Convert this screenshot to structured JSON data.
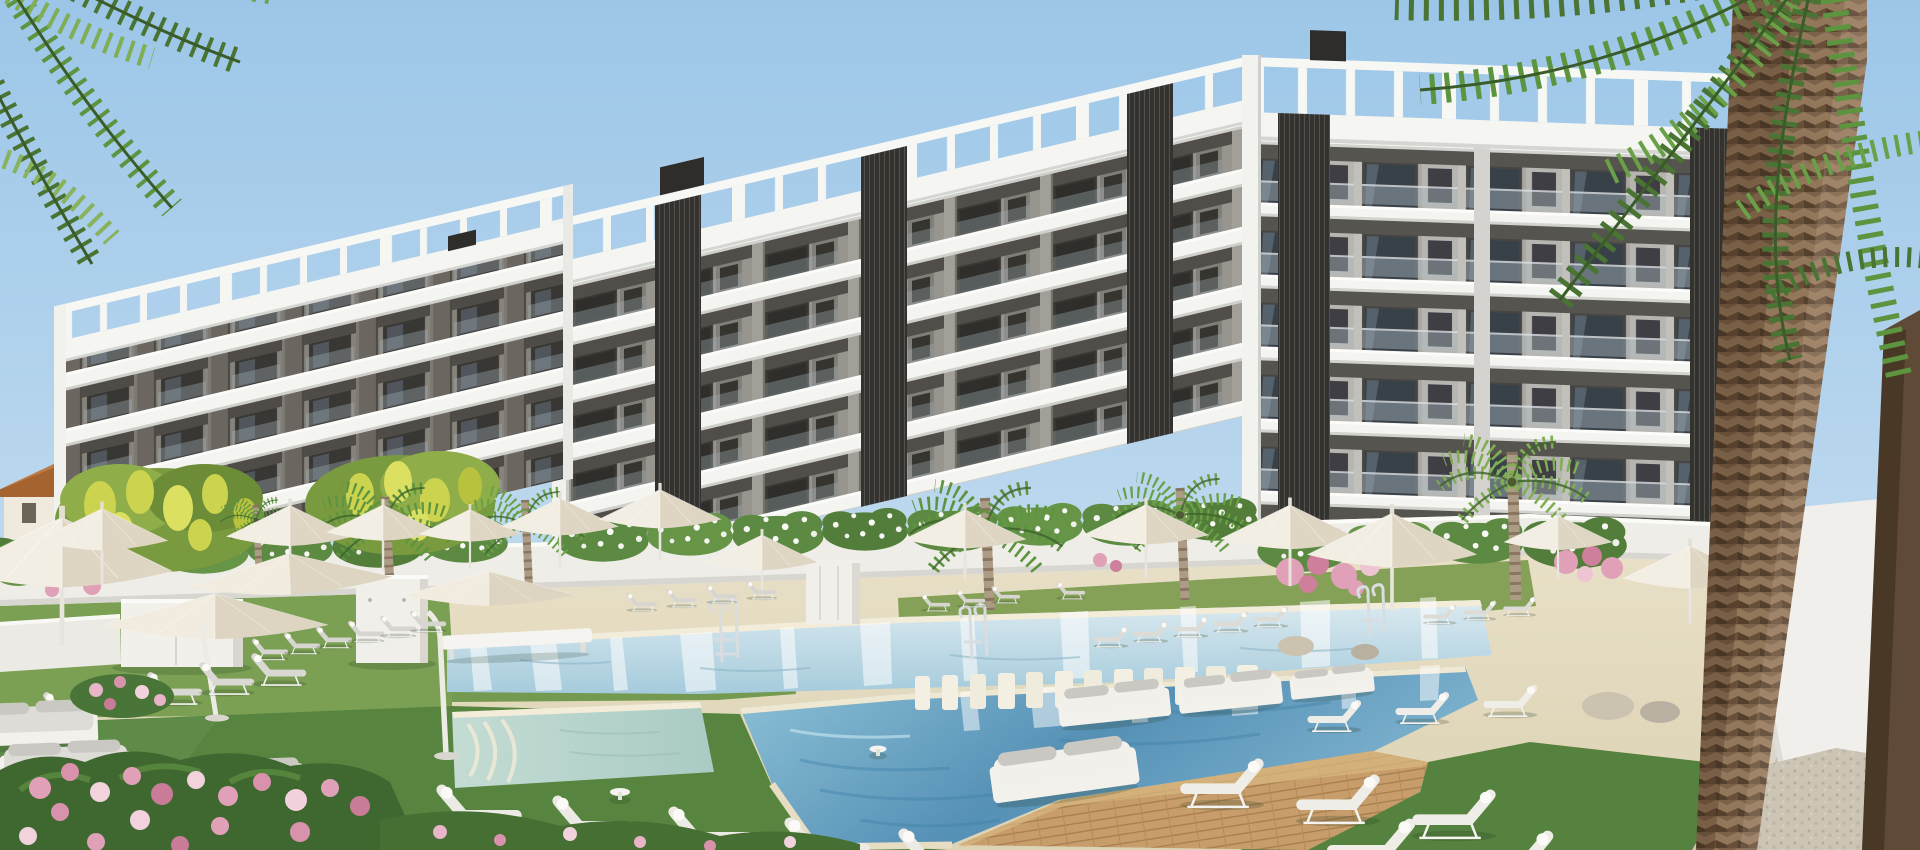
{
  "palette": {
    "sky_top": "#9cc6e8",
    "sky_bottom": "#cfe3f2",
    "slab_white": "#f4f4f1",
    "building_wall_a": "#98948e",
    "building_wall_b": "#aaa8a3",
    "building_wall_l": "#86827c",
    "recess_dark": "#3a3733",
    "louver_dark": "#34322f",
    "pergola_white": "#f7f7f4",
    "lawn_far": "#90a863",
    "lawn_mid": "#6f9450",
    "lawn_near": "#4f7e3b",
    "deck_top": "#e9e1c8",
    "deck_bottom": "#dcd2b4",
    "wood_deck": "#c79e6b",
    "far_water_light": "#dceaf0",
    "far_water": "#a5cbdc",
    "near_water_light": "#8fc3d8",
    "near_water_deep": "#5590b5",
    "spa_water": "#c4dcd3",
    "umbrella_light": "#f3eee3",
    "umbrella_dark": "#ded6c3",
    "lounger_frame": "#f9f8f5",
    "pad_gray": "#d6d5d0",
    "pad_white": "#eceae4",
    "palm_green_dark": "#4a7433",
    "palm_green": "#5d9440",
    "palm_green_light": "#7fae55",
    "trunk_brown": "#7b6148",
    "trunk_ring": "#8a7660",
    "flower_pink": "#e0a0b8",
    "flower_purple": "#ab8ecb",
    "blossom_yellow": "#ccd44f",
    "roof_terracotta": "#bd7a45",
    "wall_white": "#eeede8",
    "gravel": "#ccc5b6"
  },
  "scene": {
    "description": "3D architectural rendering of a modern white apartment complex with rooftop pergolas, dark louvered accents, landscaped gardens, palm trees and a large outdoor pool area with cream parasols and white sun loungers",
    "time_of_day": "sunny clear daytime",
    "buildings": [
      {
        "name": "left-apartment-block",
        "visible_floors": 4,
        "style": "white slabs, dark balcony recesses, rooftop pergola"
      },
      {
        "name": "right-apartment-block-west-wing",
        "visible_floors": 5,
        "style": "white slabs, dark louver columns, rooftop pergola"
      },
      {
        "name": "right-apartment-block-south-wing",
        "visible_floors": 6,
        "style": "glass balustrades, gray panels, rooftop pergola"
      },
      {
        "name": "background-villas",
        "style": "small white houses with terracotta roofs"
      }
    ],
    "pools": [
      {
        "name": "main-pool",
        "feature": "submerged white finger-benches and wooden deck with daybeds"
      },
      {
        "name": "far-lap-pool",
        "feature": "chrome ladders"
      },
      {
        "name": "kids-spa-pool",
        "feature": "pale shallow water with steps"
      }
    ],
    "vegetation": [
      "palm-trees",
      "yellow-blossom-trees",
      "oleander-pink-flowers",
      "bougainvillea",
      "flower-hedge-on-white-wall",
      "lawns"
    ],
    "furniture": {
      "parasols_visible": 18,
      "sun_loungers_visible": 44,
      "daybeds_visible": 7,
      "white_cabana_boxes": 3
    }
  }
}
